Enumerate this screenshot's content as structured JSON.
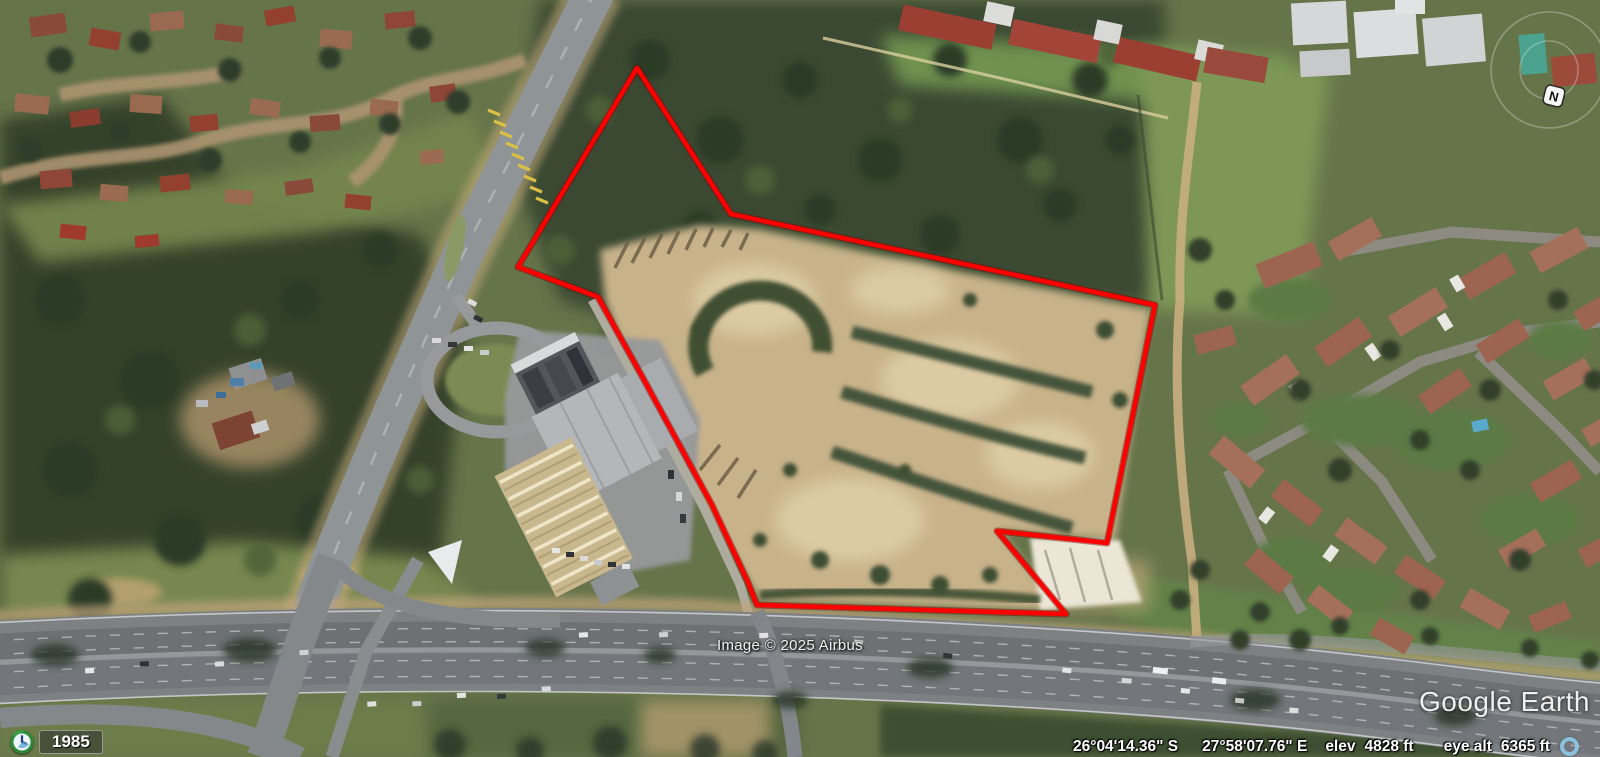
{
  "app": {
    "name": "Google Earth"
  },
  "imagery": {
    "credit": "Image © 2025 Airbus",
    "logo": "Google Earth"
  },
  "status_bar": {
    "latitude": "26°04'14.36\" S",
    "longitude": "27°58'07.76\" E",
    "elev_label": "elev",
    "elev_value": "4828 ft",
    "eye_alt_label": "eye alt",
    "eye_alt_value": "6365 ft"
  },
  "time_indicator": {
    "year": "1985"
  },
  "compass": {
    "north_label": "N"
  },
  "parcel": {
    "points": "637,68 731,214 1155,305 1107,543 997,531 1066,614 757,605 747,580 712,505 643,378 598,297 518,267",
    "outline_color": "#ff0000"
  },
  "colors": {
    "parcel_outline": "#ff0000",
    "status_text": "#ffffff",
    "streaming_indicator": "#8cc5e4",
    "dirt_site": "#c8b28a",
    "forest": "#36432c",
    "roof_terracotta": "#9d6450",
    "roof_red": "#9c3f33"
  }
}
